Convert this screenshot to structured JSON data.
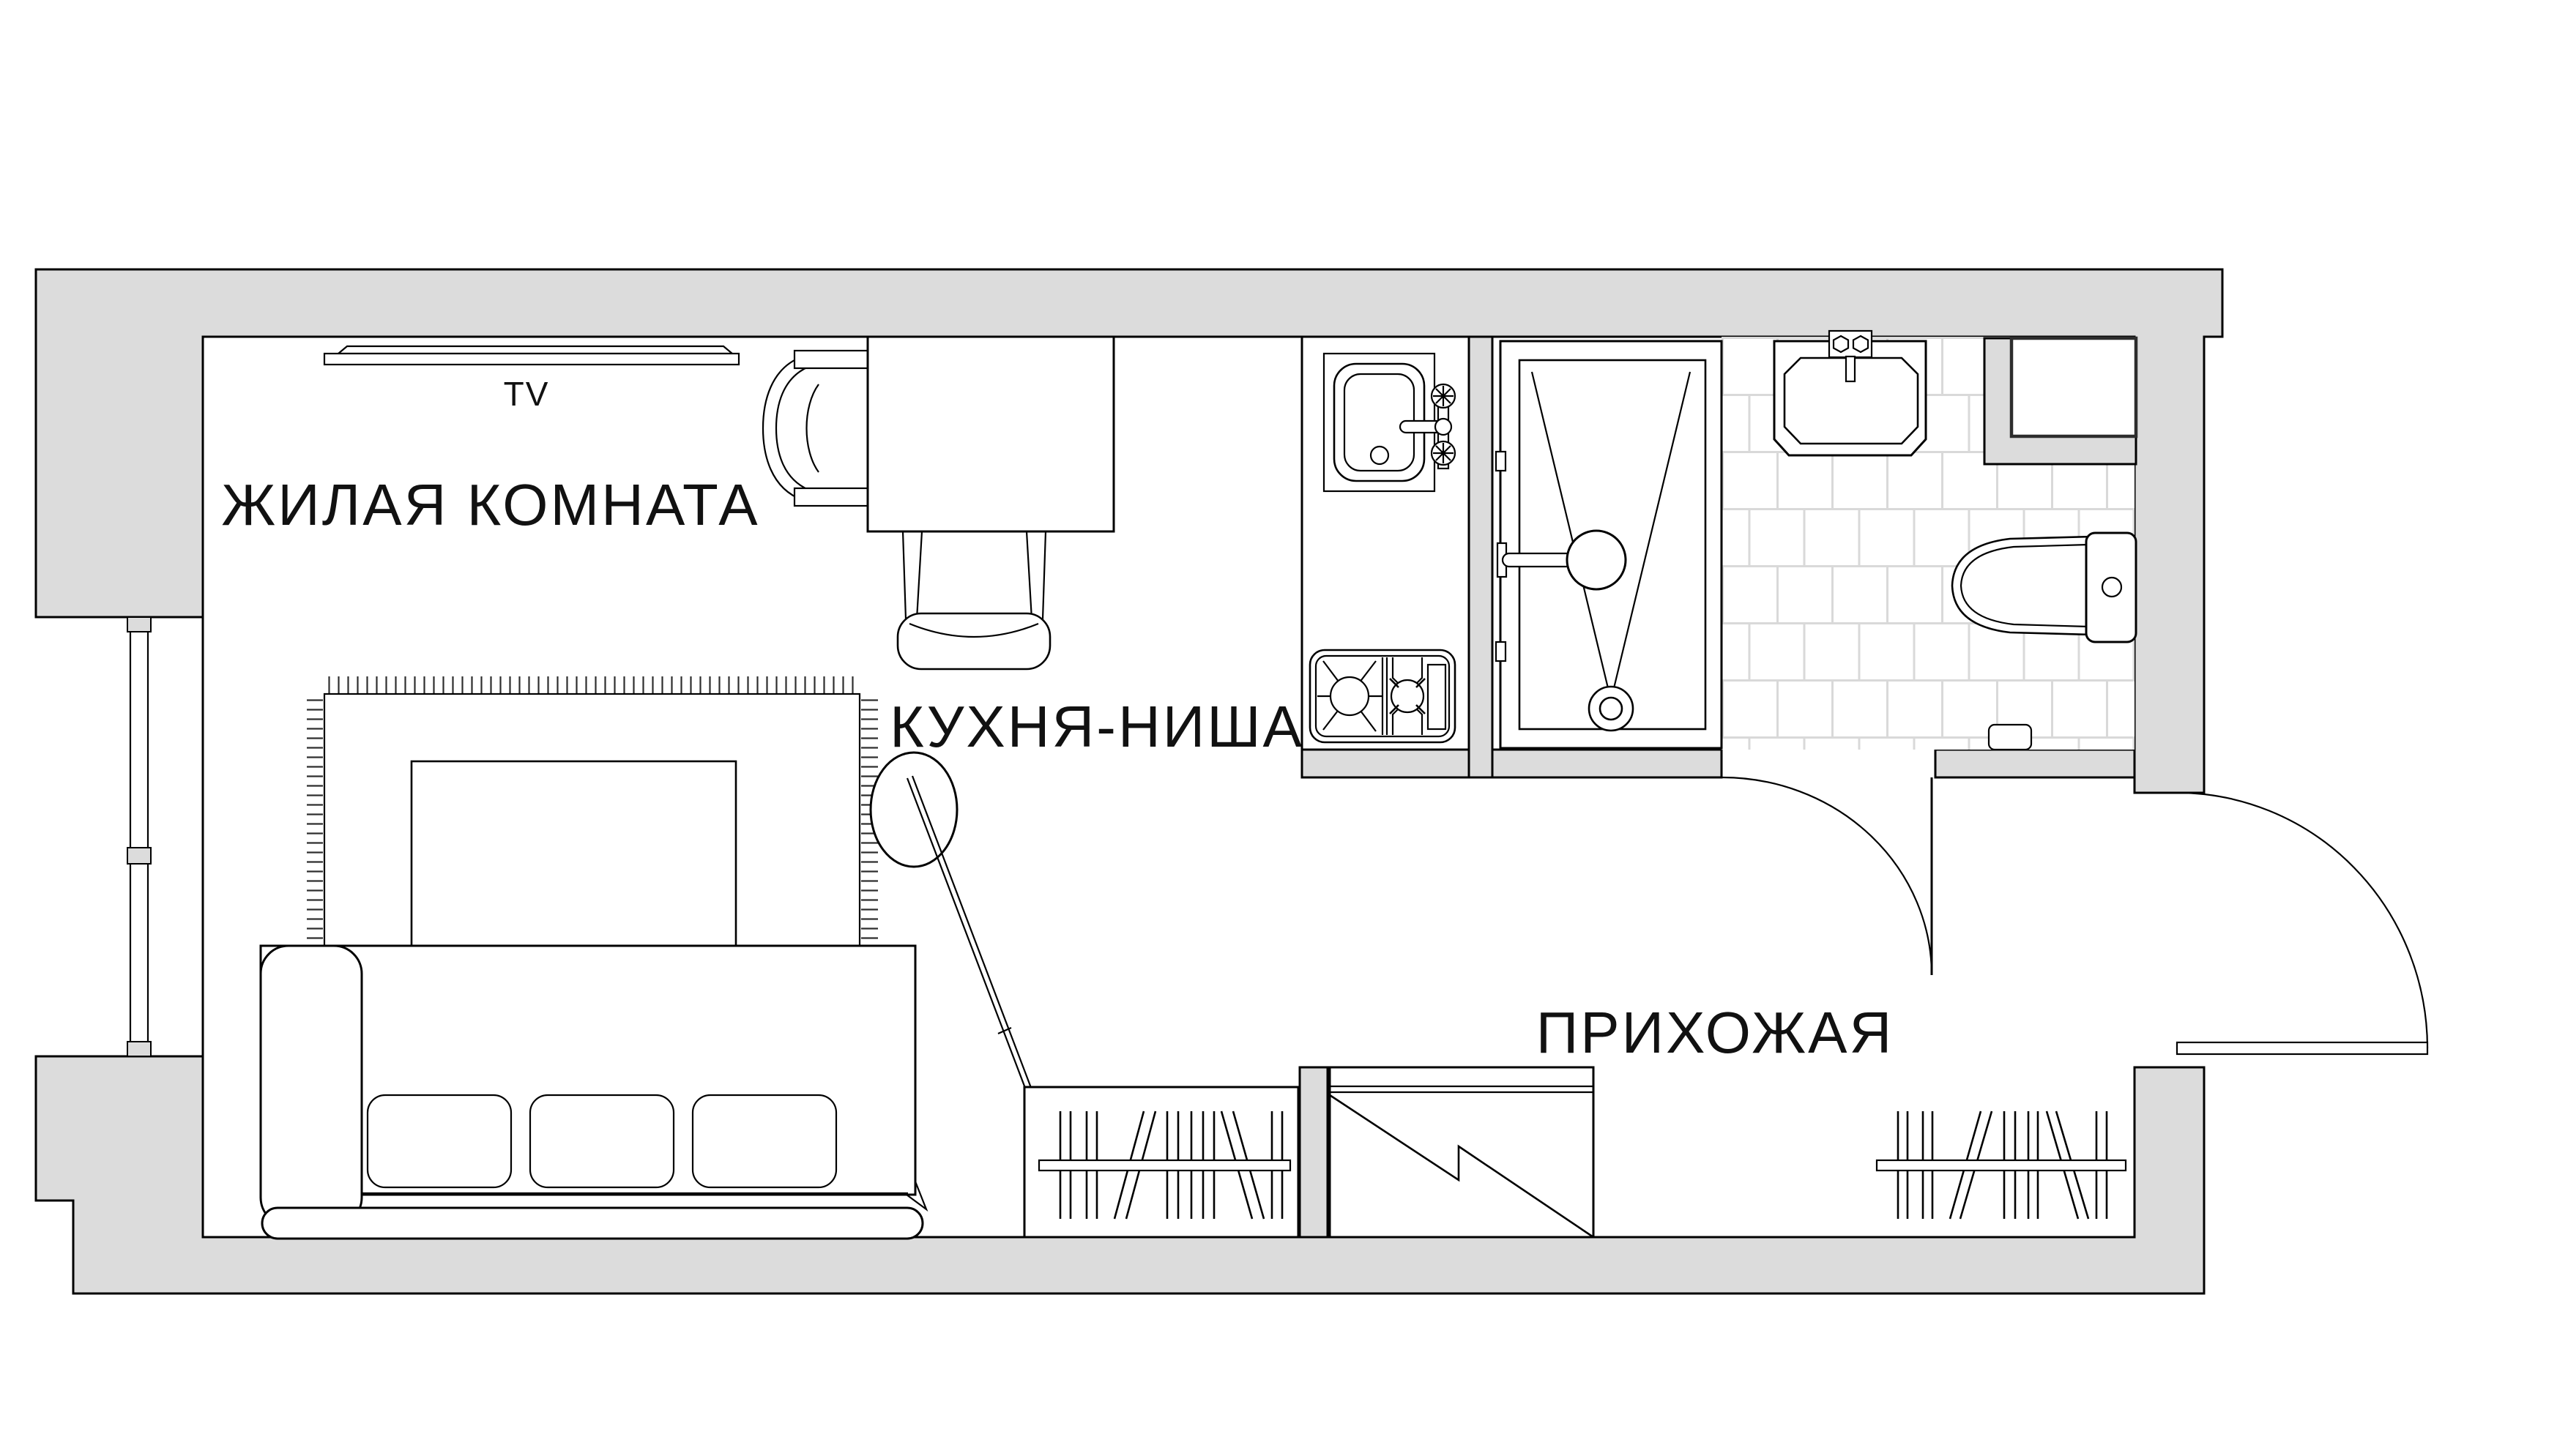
{
  "meta": {
    "drawing_type": "apartment floor plan",
    "language": "ru"
  },
  "colors": {
    "background": "#ffffff",
    "wall_fill": "#dcdcdc",
    "line": "#000000",
    "tile_grout": "#d9d9d9",
    "text": "#111111"
  },
  "rooms": {
    "living_room": {
      "label": "ЖИЛАЯ КОМНАТА"
    },
    "kitchen": {
      "label": "КУХНЯ-НИША"
    },
    "hallway": {
      "label": "ПРИХОЖАЯ"
    }
  },
  "annotations": {
    "tv_label": "TV"
  },
  "fixtures": {
    "living_room": [
      "tv",
      "dining-table",
      "armchair",
      "chair",
      "rug",
      "coffee-table",
      "floor-lamp",
      "sofa-bed",
      "wardrobe-with-clothes"
    ],
    "kitchen": [
      "kitchen-sink",
      "faucet",
      "cooktop"
    ],
    "bathroom": [
      "shower-tray",
      "shower-head",
      "washbasin",
      "toilet",
      "utility-niche",
      "tiled-floor",
      "interior-door"
    ],
    "hallway": [
      "sliding-closet",
      "coat-rack",
      "entrance-door",
      "window"
    ]
  }
}
